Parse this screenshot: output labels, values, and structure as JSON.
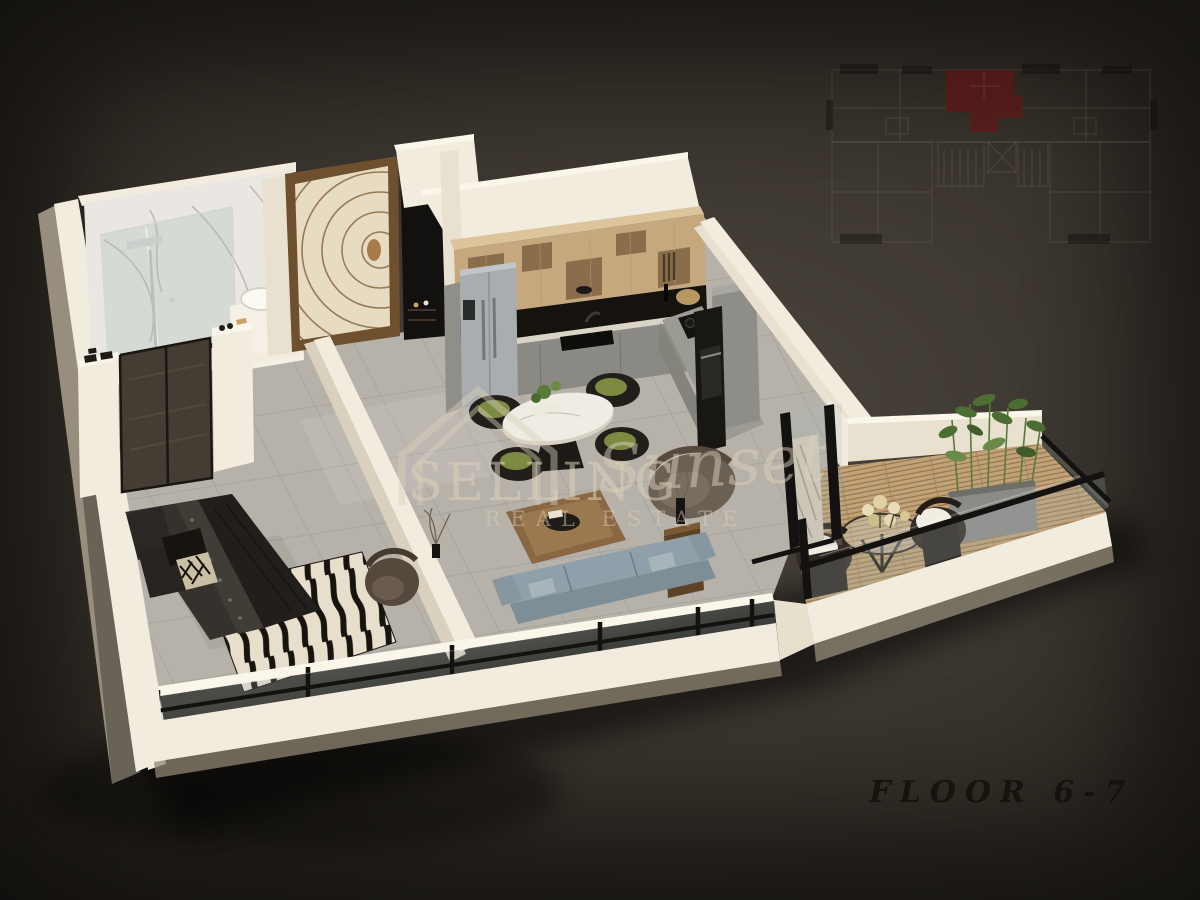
{
  "branding": {
    "name_serif": "SELLING",
    "name_script": "Sunset",
    "tagline": "REAL ESTATE"
  },
  "floor_label": "FLOOR 6-7",
  "key_plan": {
    "description": "faint 2D building key plan, symmetric tower floor with central stair/elevator core",
    "highlighted_unit": "upper-center-left apartment filled in dark red"
  },
  "scene": {
    "type": "3d-isometric-apartment-floor-plan-render",
    "rooms": [
      "bathroom",
      "entrance",
      "wardrobe-hall",
      "kitchen",
      "dining-area",
      "living-area",
      "bedroom",
      "balcony"
    ],
    "furniture": [
      "glass-shower",
      "round-basin-vanity",
      "patterned-entrance-door",
      "wood-upper-cabinets",
      "fridge",
      "gas-hob",
      "oven-column",
      "oval-dining-table",
      "four-wicker-dining-chairs",
      "blue-gray-sofa",
      "leather-coffee-table",
      "lounge-armchair",
      "side-table",
      "double-bed",
      "zebra-rug",
      "bedroom-armchair",
      "glass-wardrobe",
      "balcony-wicker-chairs",
      "balcony-glass-table",
      "bamboo-planter"
    ]
  },
  "colors": {
    "bg_center": "#4b453d",
    "bg_mid": "#3a352e",
    "bg_outer": "#2a2620",
    "bg_edge": "#171310",
    "wall": "#f2ecdf",
    "wall_shade": "#e9e1d0",
    "wall_dark": "#d9d1bd",
    "marble": "#eae7e2",
    "floor_tile": "#b6b2aa",
    "tile_line": "#9d998f",
    "wood": "#c6a87e",
    "wood_top": "#dcc49c",
    "wood_dark": "#8a6e4c",
    "cabinet_gray": "#8a8984",
    "appliance_black": "#191714",
    "steel": "#a9adaf",
    "deck": "#c2a276",
    "deck_line": "#8a6f4c",
    "sofa": "#8fa0aa",
    "accent_red": "#6d1113",
    "frame_black": "#141210",
    "glass": "rgba(165,180,180,0.22)",
    "watermark": "rgba(219,208,185,0.55)",
    "label": "#16110c"
  }
}
